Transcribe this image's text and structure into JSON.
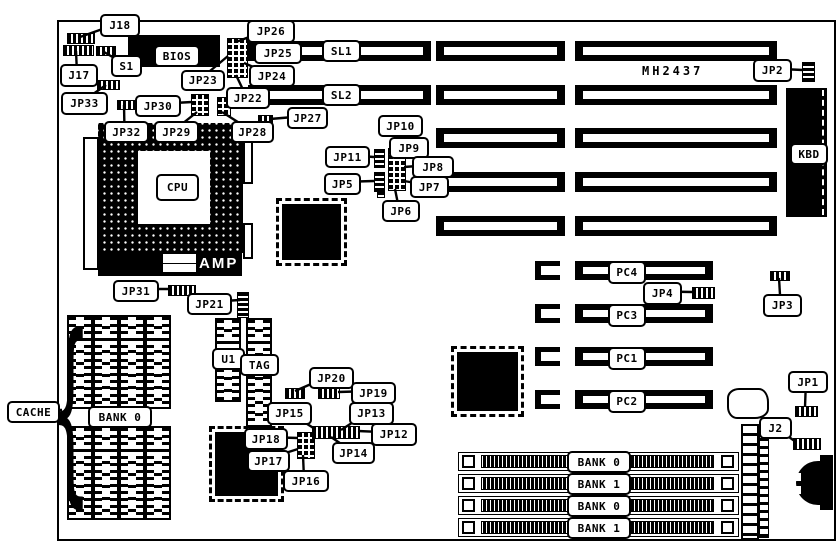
{
  "texts": {
    "amp": "AMP",
    "part_number": "MH2437",
    "cache_brace": "{"
  },
  "slots": {
    "isa_labeled": [
      "SL1",
      "SL2"
    ],
    "isa_row_count": 5,
    "pci": [
      "PC4",
      "PC3",
      "PC1",
      "PC2"
    ],
    "simm_banks": [
      "BANK 0",
      "BANK 1",
      "BANK 0",
      "BANK 1"
    ],
    "cache_bank": "BANK 0"
  },
  "colors": {
    "ink": "#000000",
    "paper": "#ffffff"
  },
  "diagram": {
    "callouts": [
      {
        "name": "callout-j18",
        "label": "J18",
        "box": [
          100,
          14,
          36,
          19
        ],
        "anchor": [
          80,
          37
        ]
      },
      {
        "name": "callout-j17",
        "label": "J17",
        "box": [
          60,
          64,
          34,
          19
        ],
        "anchor": [
          76,
          51
        ]
      },
      {
        "name": "callout-s1",
        "label": "S1",
        "box": [
          111,
          55,
          27,
          18
        ],
        "anchor": [
          104,
          52
        ]
      },
      {
        "name": "callout-jp33",
        "label": "JP33",
        "box": [
          61,
          92,
          43,
          19
        ],
        "anchor": [
          106,
          85
        ]
      },
      {
        "name": "callout-jp32",
        "label": "JP32",
        "box": [
          104,
          121,
          41,
          18
        ],
        "anchor": [
          124,
          105
        ]
      },
      {
        "name": "callout-jp30",
        "label": "JP30",
        "box": [
          135,
          95,
          42,
          18
        ],
        "anchor": [
          192,
          102
        ]
      },
      {
        "name": "callout-jp29",
        "label": "JP29",
        "box": [
          154,
          121,
          41,
          18
        ],
        "anchor": [
          197,
          112
        ]
      },
      {
        "name": "callout-jp28",
        "label": "JP28",
        "box": [
          231,
          121,
          39,
          18
        ],
        "anchor": [
          222,
          112
        ]
      },
      {
        "name": "callout-jp23",
        "label": "JP23",
        "box": [
          181,
          70,
          40,
          17
        ],
        "anchor": [
          228,
          56
        ]
      },
      {
        "name": "callout-jp26",
        "label": "JP26",
        "box": [
          247,
          20,
          44,
          19
        ],
        "anchor": [
          236,
          42
        ]
      },
      {
        "name": "callout-jp25",
        "label": "JP25",
        "box": [
          254,
          42,
          44,
          18
        ],
        "anchor": [
          246,
          52
        ]
      },
      {
        "name": "callout-jp24",
        "label": "JP24",
        "box": [
          249,
          65,
          42,
          18
        ],
        "anchor": [
          244,
          63
        ]
      },
      {
        "name": "callout-jp22",
        "label": "JP22",
        "box": [
          226,
          87,
          40,
          18
        ],
        "anchor": [
          236,
          75
        ]
      },
      {
        "name": "callout-jp27",
        "label": "JP27",
        "box": [
          287,
          107,
          37,
          18
        ],
        "anchor": [
          270,
          119
        ]
      },
      {
        "name": "callout-jp10",
        "label": "JP10",
        "box": [
          378,
          115,
          41,
          18
        ],
        "anchor": [
          395,
          149
        ]
      },
      {
        "name": "callout-jp11",
        "label": "JP11",
        "box": [
          325,
          146,
          41,
          18
        ],
        "anchor": [
          374,
          157
        ]
      },
      {
        "name": "callout-jp9",
        "label": "JP9",
        "box": [
          389,
          137,
          36,
          18
        ],
        "anchor": [
          403,
          154
        ]
      },
      {
        "name": "callout-jp8",
        "label": "JP8",
        "box": [
          412,
          156,
          38,
          18
        ],
        "anchor": [
          404,
          167
        ]
      },
      {
        "name": "callout-jp7",
        "label": "JP7",
        "box": [
          410,
          176,
          35,
          18
        ],
        "anchor": [
          404,
          181
        ]
      },
      {
        "name": "callout-jp5",
        "label": "JP5",
        "box": [
          324,
          173,
          33,
          18
        ],
        "anchor": [
          374,
          181
        ]
      },
      {
        "name": "callout-jp6",
        "label": "JP6",
        "box": [
          382,
          200,
          34,
          18
        ],
        "anchor": [
          395,
          189
        ]
      },
      {
        "name": "callout-jp2",
        "label": "JP2",
        "box": [
          753,
          59,
          35,
          19
        ],
        "anchor": [
          803,
          70
        ]
      },
      {
        "name": "callout-jp4",
        "label": "JP4",
        "box": [
          643,
          282,
          35,
          19
        ],
        "anchor": [
          693,
          292
        ]
      },
      {
        "name": "callout-jp3",
        "label": "JP3",
        "box": [
          763,
          294,
          35,
          19
        ],
        "anchor": [
          779,
          278
        ]
      },
      {
        "name": "callout-jp1",
        "label": "JP1",
        "box": [
          788,
          371,
          36,
          18
        ],
        "anchor": [
          805,
          407
        ]
      },
      {
        "name": "callout-j2",
        "label": "J2",
        "box": [
          759,
          417,
          29,
          18
        ],
        "anchor": [
          796,
          442
        ]
      },
      {
        "name": "callout-jp31",
        "label": "JP31",
        "box": [
          113,
          280,
          42,
          18
        ],
        "anchor": [
          170,
          289
        ]
      },
      {
        "name": "callout-jp21",
        "label": "JP21",
        "box": [
          187,
          293,
          41,
          18
        ],
        "anchor": [
          240,
          300
        ]
      },
      {
        "name": "callout-jp20",
        "label": "JP20",
        "box": [
          309,
          367,
          41,
          18
        ],
        "anchor": [
          295,
          391
        ]
      },
      {
        "name": "callout-jp19",
        "label": "JP19",
        "box": [
          351,
          382,
          41,
          18
        ],
        "anchor": [
          338,
          392
        ]
      },
      {
        "name": "callout-jp15",
        "label": "JP15",
        "box": [
          267,
          402,
          41,
          19
        ],
        "anchor": [
          315,
          429
        ]
      },
      {
        "name": "callout-jp13",
        "label": "JP13",
        "box": [
          349,
          402,
          41,
          19
        ],
        "anchor": [
          341,
          430
        ]
      },
      {
        "name": "callout-jp12",
        "label": "JP12",
        "box": [
          371,
          423,
          42,
          19
        ],
        "anchor": [
          358,
          431
        ]
      },
      {
        "name": "callout-jp14",
        "label": "JP14",
        "box": [
          332,
          442,
          39,
          18
        ],
        "anchor": [
          331,
          437
        ]
      },
      {
        "name": "callout-jp18",
        "label": "JP18",
        "box": [
          244,
          428,
          40,
          18
        ],
        "anchor": [
          298,
          438
        ]
      },
      {
        "name": "callout-jp17",
        "label": "JP17",
        "box": [
          247,
          450,
          39,
          18
        ],
        "anchor": [
          298,
          449
        ]
      },
      {
        "name": "callout-jp16",
        "label": "JP16",
        "box": [
          283,
          470,
          42,
          18
        ],
        "anchor": [
          303,
          455
        ]
      },
      {
        "name": "callout-cache",
        "label": "CACHE",
        "box": [
          7,
          401,
          49,
          18
        ],
        "anchor": [
          62,
          410
        ]
      }
    ],
    "part_labels": [
      {
        "name": "part-label-bios",
        "label": "BIOS",
        "box": [
          154,
          45,
          42,
          18
        ]
      },
      {
        "name": "part-label-cpu",
        "label": "CPU",
        "box": [
          156,
          174,
          39,
          23
        ]
      },
      {
        "name": "part-label-sl1",
        "label": "SL1",
        "box": [
          322,
          40,
          35,
          18
        ]
      },
      {
        "name": "part-label-sl2",
        "label": "SL2",
        "box": [
          322,
          84,
          35,
          18
        ]
      },
      {
        "name": "part-label-pc4",
        "label": "PC4",
        "box": [
          608,
          261,
          34,
          19
        ]
      },
      {
        "name": "part-label-pc3",
        "label": "PC3",
        "box": [
          608,
          304,
          34,
          19
        ]
      },
      {
        "name": "part-label-pc1",
        "label": "PC1",
        "box": [
          608,
          347,
          34,
          19
        ]
      },
      {
        "name": "part-label-pc2",
        "label": "PC2",
        "box": [
          608,
          390,
          34,
          19
        ]
      },
      {
        "name": "part-label-kbd",
        "label": "KBD",
        "box": [
          790,
          143,
          34,
          18
        ]
      },
      {
        "name": "part-label-u1",
        "label": "U1",
        "box": [
          212,
          348,
          29,
          18
        ]
      },
      {
        "name": "part-label-tag",
        "label": "TAG",
        "box": [
          240,
          354,
          35,
          18
        ]
      },
      {
        "name": "part-label-cache-bank0",
        "label": "BANK 0",
        "box": [
          88,
          406,
          60,
          18
        ]
      },
      {
        "name": "part-label-simm-bank0a",
        "label": "BANK 0",
        "box": [
          567,
          451,
          60,
          18
        ]
      },
      {
        "name": "part-label-simm-bank1a",
        "label": "BANK 1",
        "box": [
          567,
          473,
          60,
          18
        ]
      },
      {
        "name": "part-label-simm-bank0b",
        "label": "BANK 0",
        "box": [
          567,
          495,
          60,
          18
        ]
      },
      {
        "name": "part-label-simm-bank1b",
        "label": "BANK 1",
        "box": [
          567,
          517,
          60,
          18
        ]
      }
    ]
  }
}
